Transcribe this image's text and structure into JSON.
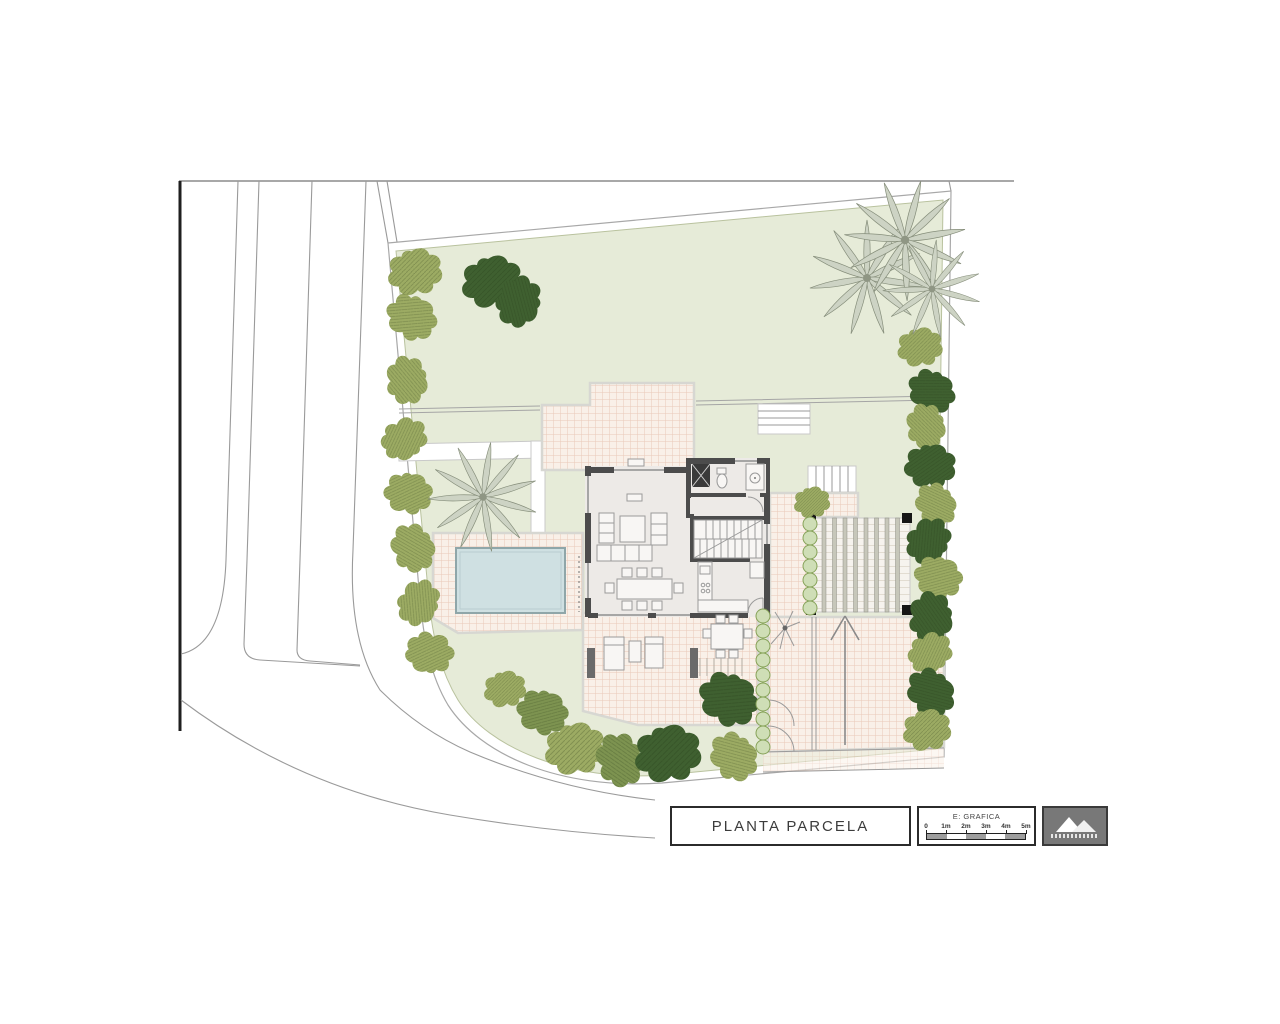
{
  "title_block": {
    "drawing_title": "PLANTA PARCELA",
    "scale": {
      "label": "E: GRAFICA",
      "ticks": [
        "0",
        "1m",
        "2m",
        "3m",
        "4m",
        "5m"
      ],
      "segment_colors": [
        "#9e9e9e",
        "#ffffff",
        "#9e9e9e",
        "#ffffff",
        "#9e9e9e"
      ]
    },
    "logo": {
      "icon": "twin-peaks-logo"
    }
  },
  "palette": {
    "lawn": "#e6ebd8",
    "tile_bg": "#f9f0e8",
    "tile_line": "#e9c9b8",
    "pool": "#cfe0e2",
    "tree_light": "#9cab63",
    "tree_mid": "#7d9350",
    "tree_dark": "#3f6030",
    "palm": "#cdd3c4",
    "palm_outline": "#868e7b",
    "wall": "#4c4c4c",
    "house_floor": "#edeae7",
    "road_line": "#9a9a9a",
    "frame": "#1f1f1f",
    "bush_fill": "#cfdeb6",
    "bush_stroke": "#86a258"
  },
  "plan": {
    "areas": [
      "street",
      "parcel-boundary",
      "lawn",
      "swimming-pool",
      "pool-terrace",
      "upper-patio",
      "house",
      "south-terrace",
      "pergola-carport",
      "driveway",
      "garden-steps",
      "hedges",
      "trees",
      "palm-trees"
    ],
    "trees": [
      {
        "x": 415,
        "y": 273,
        "s": 0.9,
        "r": 0,
        "c": "L"
      },
      {
        "x": 411,
        "y": 318,
        "s": 0.85,
        "r": 40,
        "c": "L"
      },
      {
        "x": 406,
        "y": 380,
        "s": 0.8,
        "r": 95,
        "c": "L"
      },
      {
        "x": 404,
        "y": 438,
        "s": 0.78,
        "r": 160,
        "c": "L"
      },
      {
        "x": 408,
        "y": 494,
        "s": 0.8,
        "r": 20,
        "c": "L"
      },
      {
        "x": 412,
        "y": 548,
        "s": 0.82,
        "r": 75,
        "c": "L"
      },
      {
        "x": 418,
        "y": 602,
        "s": 0.78,
        "r": 130,
        "c": "L"
      },
      {
        "x": 430,
        "y": 652,
        "s": 0.8,
        "r": 200,
        "c": "L"
      },
      {
        "x": 492,
        "y": 283,
        "s": 1.0,
        "r": 0,
        "c": "D"
      },
      {
        "x": 518,
        "y": 301,
        "s": 0.85,
        "r": 120,
        "c": "D"
      },
      {
        "x": 505,
        "y": 690,
        "s": 0.7,
        "r": 0,
        "c": "L"
      },
      {
        "x": 542,
        "y": 713,
        "s": 0.85,
        "r": 30,
        "c": "M"
      },
      {
        "x": 575,
        "y": 750,
        "s": 1.0,
        "r": 0,
        "c": "L"
      },
      {
        "x": 619,
        "y": 760,
        "s": 0.9,
        "r": 80,
        "c": "M"
      },
      {
        "x": 668,
        "y": 755,
        "s": 1.1,
        "r": 0,
        "c": "D"
      },
      {
        "x": 728,
        "y": 700,
        "s": 1.0,
        "r": 40,
        "c": "D"
      },
      {
        "x": 733,
        "y": 757,
        "s": 0.85,
        "r": 60,
        "c": "L"
      },
      {
        "x": 812,
        "y": 503,
        "s": 0.6,
        "r": 0,
        "c": "L"
      },
      {
        "x": 920,
        "y": 348,
        "s": 0.75,
        "r": 0,
        "c": "L"
      },
      {
        "x": 931,
        "y": 392,
        "s": 0.8,
        "r": 45,
        "c": "D"
      },
      {
        "x": 925,
        "y": 426,
        "s": 0.75,
        "r": 90,
        "c": "L"
      },
      {
        "x": 930,
        "y": 467,
        "s": 0.85,
        "r": 10,
        "c": "D"
      },
      {
        "x": 935,
        "y": 505,
        "s": 0.75,
        "r": 70,
        "c": "L"
      },
      {
        "x": 928,
        "y": 540,
        "s": 0.8,
        "r": 140,
        "c": "D"
      },
      {
        "x": 938,
        "y": 578,
        "s": 0.8,
        "r": 30,
        "c": "L"
      },
      {
        "x": 930,
        "y": 617,
        "s": 0.85,
        "r": 100,
        "c": "D"
      },
      {
        "x": 930,
        "y": 652,
        "s": 0.75,
        "r": 160,
        "c": "L"
      },
      {
        "x": 930,
        "y": 693,
        "s": 0.85,
        "r": 60,
        "c": "D"
      },
      {
        "x": 927,
        "y": 731,
        "s": 0.8,
        "r": 0,
        "c": "L"
      }
    ],
    "palms": [
      {
        "x": 867,
        "y": 278,
        "s": 1.0,
        "r": 0
      },
      {
        "x": 905,
        "y": 240,
        "s": 1.05,
        "r": 15
      },
      {
        "x": 932,
        "y": 289,
        "s": 0.85,
        "r": 40
      },
      {
        "x": 483,
        "y": 497,
        "s": 0.95,
        "r": 8
      }
    ],
    "bushes": [
      {
        "x": 810,
        "y": 524
      },
      {
        "x": 810,
        "y": 538
      },
      {
        "x": 810,
        "y": 552
      },
      {
        "x": 810,
        "y": 566
      },
      {
        "x": 810,
        "y": 580
      },
      {
        "x": 810,
        "y": 594
      },
      {
        "x": 810,
        "y": 608
      },
      {
        "x": 763,
        "y": 616
      },
      {
        "x": 763,
        "y": 631
      },
      {
        "x": 763,
        "y": 646
      },
      {
        "x": 763,
        "y": 660
      },
      {
        "x": 763,
        "y": 675
      },
      {
        "x": 763,
        "y": 690
      },
      {
        "x": 763,
        "y": 704
      },
      {
        "x": 763,
        "y": 719
      },
      {
        "x": 763,
        "y": 733
      },
      {
        "x": 763,
        "y": 747
      }
    ]
  }
}
